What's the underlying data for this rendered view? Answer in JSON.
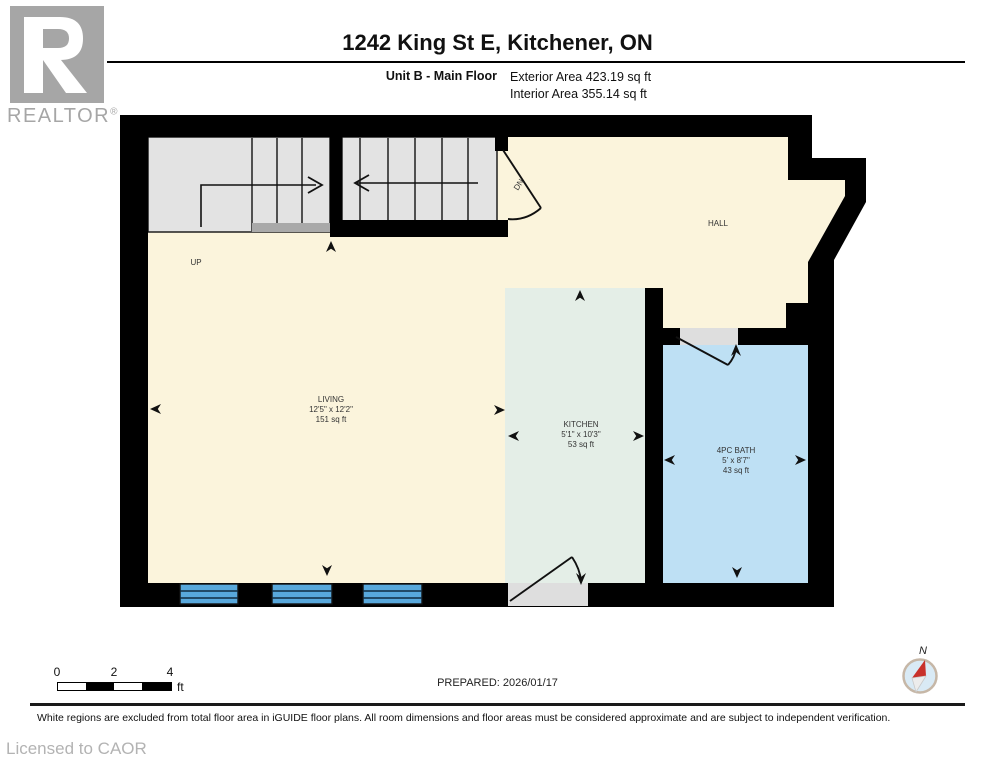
{
  "header": {
    "title": "1242 King St E, Kitchener, ON",
    "unit_label": "Unit B - Main Floor",
    "exterior_area": "Exterior Area 423.19 sq ft",
    "interior_area": "Interior Area 355.14 sq ft",
    "logo_text": "REALTOR",
    "logo_mark": "®"
  },
  "plan": {
    "rooms": {
      "living": {
        "name": "LIVING",
        "dims": "12'5\" x 12'2\"",
        "area": "151 sq ft"
      },
      "kitchen": {
        "name": "KITCHEN",
        "dims": "5'1\" x 10'3\"",
        "area": "53 sq ft"
      },
      "bath": {
        "name": "4PC BATH",
        "dims": "5' x 8'7\"",
        "area": "43 sq ft"
      },
      "hall": {
        "name": "HALL"
      }
    },
    "stairs": {
      "up": "UP",
      "down": "DN"
    }
  },
  "scalebar": {
    "t0": "0",
    "t2": "2",
    "t4": "4",
    "unit": "ft"
  },
  "prepared": "PREPARED: 2026/01/17",
  "compass": {
    "north": "N"
  },
  "footer": {
    "disclaimer": "White regions are excluded from total floor area in iGUIDE floor plans. All room dimensions and floor areas must be considered approximate and are subject to independent verification.",
    "license": "Licensed to CAOR"
  },
  "colors": {
    "wall": "#000000",
    "living": "#FBF4DC",
    "kitchen": "#E4EEE7",
    "bath": "#BEE0F4",
    "stairs": "#E3E3E3",
    "window": "#58A8DC",
    "threshold_light": "#DEDEDE",
    "threshold_dark": "#A9A9A9",
    "compass_red": "#C8312B",
    "logo_gray": "#A6A6A6"
  }
}
